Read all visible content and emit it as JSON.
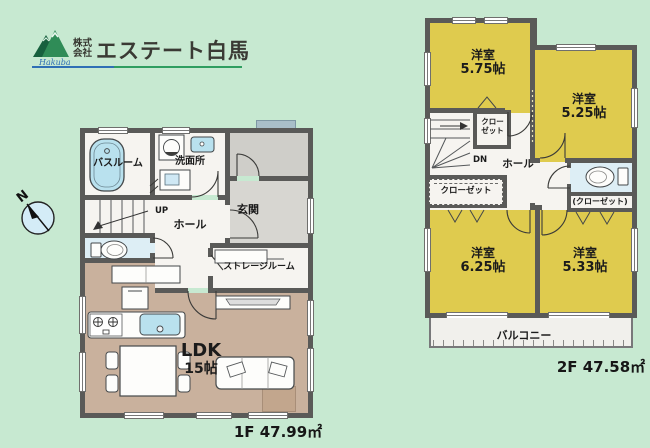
{
  "logo": {
    "prefix": "株式会社",
    "company": "エステート白馬",
    "script": "Hakuba"
  },
  "compass": {
    "north": "N"
  },
  "floor1": {
    "caption": "1F 47.99㎡",
    "bathroom": "バスルーム",
    "washroom": "洗面所",
    "entrance": "玄関",
    "hall": "ホール",
    "stairs": "UP",
    "storage": "ストレージルーム",
    "ldk": "LDK",
    "ldk_size": "15帖"
  },
  "floor2": {
    "caption": "2F 47.58㎡",
    "room_nw": {
      "name": "洋室",
      "size": "5.75帖"
    },
    "room_ne": {
      "name": "洋室",
      "size": "5.25帖"
    },
    "room_sw": {
      "name": "洋室",
      "size": "6.25帖"
    },
    "room_se": {
      "name": "洋室",
      "size": "5.33帖"
    },
    "closet_stairs": "クローゼット",
    "closet_w": "クローゼット",
    "closet_e": "(クローゼット)",
    "stairs": "DN",
    "hall": "ホール",
    "balcony": "バルコニー"
  },
  "colors": {
    "background": "#c7e9d1",
    "wall": "#5a5a58",
    "room_yellow": "#dfcb4e",
    "ldk_tan": "#c9b19d",
    "tile": "#d7d6d1",
    "water": "#b9e1ee",
    "toilet_floor": "#ddeef5",
    "floor_white": "#f6f4f0"
  }
}
